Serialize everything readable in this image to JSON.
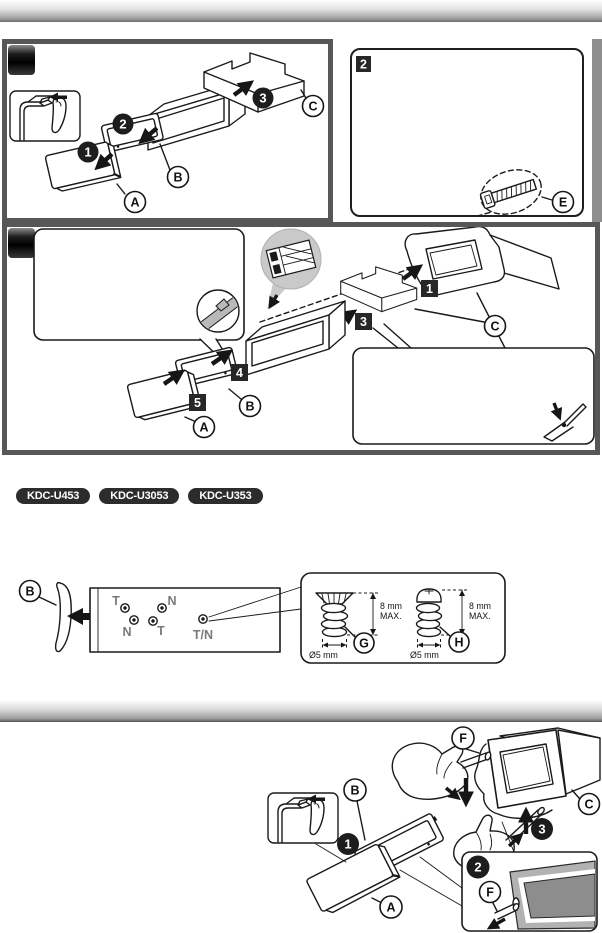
{
  "page": {
    "width": 602,
    "height": 933
  },
  "colors": {
    "panel_border": "#575757",
    "ink": "#1a1a1a",
    "badge_bg": "#2c2c2c",
    "gray_label": "#7a7a7a",
    "bubble_gray": "#c9c9c9",
    "frame_gray": "#b2b2b2",
    "opening_gray": "#8d8d8d",
    "divider_dark": "#565656"
  },
  "panel_install_kit": {
    "steps": {
      "s1": "1",
      "s2": "2",
      "s3": "3"
    },
    "parts": {
      "a": "A",
      "b": "B",
      "c": "C"
    }
  },
  "panel_two": {
    "number": "2",
    "part_e": "E"
  },
  "panel_install_dash": {
    "step_boxes": {
      "b1": "1",
      "b3": "3",
      "b4": "4",
      "b5": "5"
    },
    "parts": {
      "a": "A",
      "b": "B",
      "c": "C"
    }
  },
  "model_badges": {
    "b1": "KDC-U453",
    "b2": "KDC-U3053",
    "b3": "KDC-U353"
  },
  "screw_panel": {
    "part_b": "B",
    "holes": {
      "t1": "T",
      "n1": "N",
      "n2": "N",
      "t2": "T",
      "tn": "T/N"
    },
    "screw_g": {
      "label": "G",
      "h": "8 mm",
      "max": "MAX.",
      "dia": "Ø5 mm"
    },
    "screw_h": {
      "label": "H",
      "h": "8 mm",
      "max": "MAX.",
      "dia": "Ø5 mm"
    }
  },
  "removal": {
    "steps": {
      "s1": "1",
      "s2": "2",
      "s3": "3"
    },
    "parts": {
      "a": "A",
      "b": "B",
      "c": "C",
      "f": "F",
      "f2": "F"
    }
  }
}
